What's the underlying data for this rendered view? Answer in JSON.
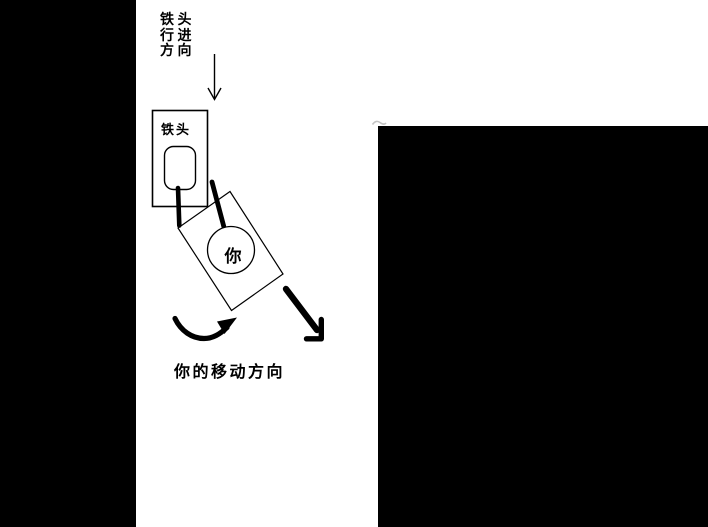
{
  "image": {
    "kind": "hand-drawn instructional diagram",
    "colors": {
      "background": "#ffffff",
      "side_panels": "#000000",
      "ink": "#000000",
      "smudge": "#c4c4c4"
    }
  },
  "labels": {
    "approach_lines": [
      "铁头",
      "行进",
      "方向"
    ],
    "approach_full": "铁头行进方向",
    "hammer_box": "铁头",
    "you": "你",
    "movement": "你的移动方向"
  },
  "arrows": {
    "approach": "thin-down-arrow",
    "rotation": "curved-counterclockwise-arrow",
    "movement": "thick-down-right-arrow"
  }
}
